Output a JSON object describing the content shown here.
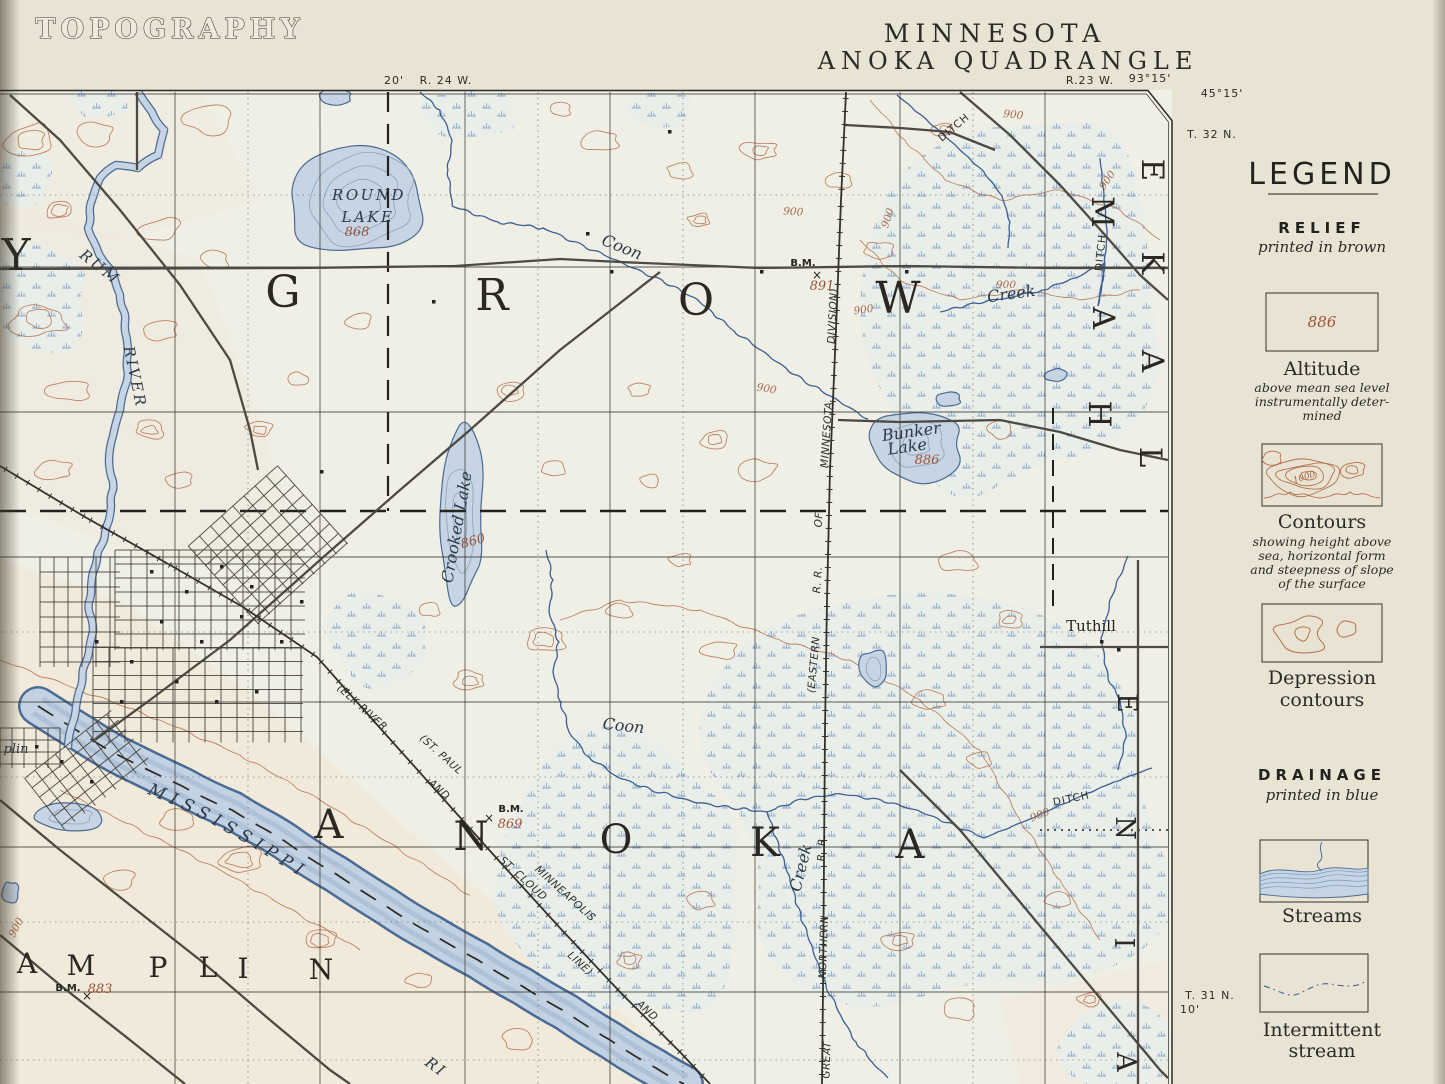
{
  "colors": {
    "paper": "#e9e3d4",
    "map_paper": "#f0efe5",
    "pink_tint": "#f3e3d2",
    "relief_brown": "#b4714c",
    "relief_number_brown": "#9e5237",
    "drainage_blue": "#4a6b94",
    "water_fill": "#c6d4e3",
    "marsh_blue": "#7fa0c6",
    "ink_black": "#262420",
    "road_grey": "#4c4a42"
  },
  "header": {
    "sheet_title": "TOPOGRAPHY",
    "state": "MINNESOTA",
    "quadrangle": "ANOKA QUADRANGLE"
  },
  "margin": {
    "top_minute": "20'",
    "range_west": "R. 24 W.",
    "range_east": "R.23 W.",
    "longitude": "93°15'",
    "latitude": "45°15'",
    "township_ne": "T. 32 N.",
    "township_se": "T. 31 N.",
    "minute_se": "10'"
  },
  "legend": {
    "title": "LEGEND",
    "relief_heading": "RELIEF",
    "relief_sub": "printed in brown",
    "altitude_value": "886",
    "altitude_label": "Altitude",
    "altitude_desc_lines": [
      "above mean sea level",
      "instrumentally deter-",
      "mined"
    ],
    "contour_value": "1000",
    "contours_label": "Contours",
    "contours_desc_lines": [
      "showing height above",
      "sea, horizontal form",
      "and steepness of slope",
      "of the surface"
    ],
    "depression_label_lines": [
      "Depression",
      "contours"
    ],
    "drainage_heading": "DRAINAGE",
    "drainage_sub": "printed in blue",
    "streams_label": "Streams",
    "intermittent_label_lines": [
      "Intermittent",
      "stream"
    ]
  },
  "map": {
    "river_label": "MISSISSIPPI",
    "labels": [
      {
        "t": "Y",
        "x": 16,
        "y": 270,
        "r": 0,
        "c": "lg1",
        "n": "label-county-letter-y"
      },
      {
        "t": "G",
        "x": 283,
        "y": 307,
        "r": 0,
        "c": "lg1",
        "n": "label-grow-g"
      },
      {
        "t": "R",
        "x": 492,
        "y": 310,
        "r": 0,
        "c": "lg1",
        "n": "label-grow-r"
      },
      {
        "t": "O",
        "x": 696,
        "y": 315,
        "r": 0,
        "c": "lg1",
        "n": "label-grow-o"
      },
      {
        "t": "W",
        "x": 898,
        "y": 313,
        "r": 0,
        "c": "lg1",
        "n": "label-grow-w"
      },
      {
        "t": "A",
        "x": 329,
        "y": 838,
        "r": 0,
        "c": "lg2",
        "n": "label-anoka-a1"
      },
      {
        "t": "N",
        "x": 471,
        "y": 850,
        "r": 0,
        "c": "lg2",
        "n": "label-anoka-n"
      },
      {
        "t": "O",
        "x": 616,
        "y": 853,
        "r": 0,
        "c": "lg2",
        "n": "label-anoka-o"
      },
      {
        "t": "K",
        "x": 765,
        "y": 856,
        "r": 0,
        "c": "lg2",
        "n": "label-anoka-k"
      },
      {
        "t": "A",
        "x": 910,
        "y": 858,
        "r": 0,
        "c": "lg2",
        "n": "label-anoka-a2"
      },
      {
        "t": "A",
        "x": 27,
        "y": 973,
        "r": 0,
        "c": "lg3",
        "n": "label-champlin-a"
      },
      {
        "t": "M",
        "x": 81,
        "y": 975,
        "r": 0,
        "c": "lg3",
        "n": "label-champlin-m"
      },
      {
        "t": "P",
        "x": 158,
        "y": 977,
        "r": 0,
        "c": "lg3",
        "n": "label-champlin-p"
      },
      {
        "t": "L",
        "x": 208,
        "y": 977,
        "r": 0,
        "c": "lg3",
        "n": "label-champlin-l"
      },
      {
        "t": "I",
        "x": 243,
        "y": 978,
        "r": 0,
        "c": "lg3",
        "n": "label-champlin-i"
      },
      {
        "t": "N",
        "x": 321,
        "y": 979,
        "r": 0,
        "c": "lg3",
        "n": "label-champlin-n"
      },
      {
        "t": "M",
        "x": 1092,
        "y": 212,
        "r": 90,
        "c": "lg4",
        "n": "label-ham-m"
      },
      {
        "t": "A",
        "x": 1093,
        "y": 318,
        "r": 90,
        "c": "lg4",
        "n": "label-ham-a"
      },
      {
        "t": "H",
        "x": 1089,
        "y": 414,
        "r": 90,
        "c": "lg4",
        "n": "label-ham-h"
      },
      {
        "t": "E",
        "x": 1142,
        "y": 170,
        "r": 90,
        "c": "lg4",
        "n": "label-lake-e"
      },
      {
        "t": "K",
        "x": 1142,
        "y": 263,
        "r": 90,
        "c": "lg4",
        "n": "label-lake-k"
      },
      {
        "t": "A",
        "x": 1142,
        "y": 361,
        "r": 90,
        "c": "lg4",
        "n": "label-lake-a"
      },
      {
        "t": "L",
        "x": 1140,
        "y": 457,
        "r": 90,
        "c": "lg4",
        "n": "label-lake-l"
      },
      {
        "t": "E",
        "x": 1118,
        "y": 703,
        "r": 90,
        "c": "lg5",
        "n": "label-blaine-e"
      },
      {
        "t": "N",
        "x": 1116,
        "y": 828,
        "r": 90,
        "c": "lg5",
        "n": "label-blaine-n"
      },
      {
        "t": "I",
        "x": 1115,
        "y": 943,
        "r": 90,
        "c": "lg5",
        "n": "label-blaine-i"
      },
      {
        "t": "A",
        "x": 1117,
        "y": 1062,
        "r": 90,
        "c": "lg5",
        "n": "label-blaine-a"
      },
      {
        "t": "ROUND",
        "x": 369,
        "y": 200,
        "r": 0,
        "c": "watc",
        "n": "label-round-lake-1"
      },
      {
        "t": "LAKE",
        "x": 368,
        "y": 222,
        "r": 0,
        "c": "watc",
        "n": "label-round-lake-2"
      },
      {
        "t": "868",
        "x": 357,
        "y": 236,
        "r": 0,
        "c": "num",
        "n": "label-round-lake-elev"
      },
      {
        "t": "RUM",
        "x": 97,
        "y": 271,
        "r": 38,
        "c": "watc",
        "n": "label-rum"
      },
      {
        "t": "RIVER",
        "x": 130,
        "y": 378,
        "r": 78,
        "c": "watc",
        "n": "label-rum-river"
      },
      {
        "t": "Crooked Lake",
        "x": 462,
        "y": 528,
        "r": -80,
        "c": "wat",
        "n": "label-crooked-lake"
      },
      {
        "t": "860",
        "x": 474,
        "y": 545,
        "r": -15,
        "c": "num",
        "n": "label-crooked-lake-elev"
      },
      {
        "t": "Bunker",
        "x": 912,
        "y": 437,
        "r": -8,
        "c": "wat",
        "n": "label-bunker-lake-1"
      },
      {
        "t": "Lake",
        "x": 908,
        "y": 452,
        "r": -8,
        "c": "wat",
        "n": "label-bunker-lake-2"
      },
      {
        "t": "886",
        "x": 927,
        "y": 464,
        "r": 0,
        "c": "num",
        "n": "label-bunker-lake-elev"
      },
      {
        "t": "Coon",
        "x": 620,
        "y": 252,
        "r": 22,
        "c": "wat",
        "n": "label-coon-upper"
      },
      {
        "t": "Creek",
        "x": 1012,
        "y": 299,
        "r": -8,
        "c": "wat",
        "n": "label-creek-upper"
      },
      {
        "t": "Coon",
        "x": 623,
        "y": 731,
        "r": 6,
        "c": "wat",
        "n": "label-coon-lower"
      },
      {
        "t": "Creek",
        "x": 806,
        "y": 869,
        "r": -76,
        "c": "wat",
        "n": "label-creek-lower"
      },
      {
        "t": "plin",
        "x": 16,
        "y": 753,
        "r": 0,
        "c": "watsm",
        "n": "label-champlin-village"
      },
      {
        "t": "RI",
        "x": 433,
        "y": 1071,
        "r": 36,
        "c": "watc",
        "n": "label-river-partial"
      },
      {
        "t": "DITCH",
        "x": 956,
        "y": 130,
        "r": -40,
        "c": "sm",
        "n": "label-ditch-1"
      },
      {
        "t": "DITCH",
        "x": 1104,
        "y": 253,
        "r": -84,
        "c": "sm",
        "n": "label-ditch-2"
      },
      {
        "t": "DITCH",
        "x": 1072,
        "y": 802,
        "r": -12,
        "c": "sm",
        "n": "label-ditch-3"
      },
      {
        "t": "Tuthill",
        "x": 1091,
        "y": 631,
        "r": 0,
        "c": "loc",
        "n": "label-tuthill"
      },
      {
        "t": "B.M.",
        "x": 803,
        "y": 266,
        "r": 0,
        "c": "bm",
        "n": "label-bm-1"
      },
      {
        "t": "891",
        "x": 822,
        "y": 290,
        "r": 0,
        "c": "num",
        "n": "label-bm-1-elev"
      },
      {
        "t": "×",
        "x": 817,
        "y": 279,
        "r": 0,
        "c": "bmx",
        "n": "bm-cross-1"
      },
      {
        "t": "B.M.",
        "x": 511,
        "y": 812,
        "r": 0,
        "c": "bm",
        "n": "label-bm-2"
      },
      {
        "t": "869",
        "x": 510,
        "y": 828,
        "r": 0,
        "c": "num",
        "n": "label-bm-2-elev"
      },
      {
        "t": "×",
        "x": 489,
        "y": 822,
        "r": 0,
        "c": "bmx",
        "n": "bm-cross-2"
      },
      {
        "t": "B.M.",
        "x": 68,
        "y": 991,
        "r": 0,
        "c": "bm",
        "n": "label-bm-3"
      },
      {
        "t": "883",
        "x": 100,
        "y": 993,
        "r": 0,
        "c": "num",
        "n": "label-bm-3-elev"
      },
      {
        "t": "×",
        "x": 87,
        "y": 1000,
        "r": 0,
        "c": "bmx",
        "n": "bm-cross-3"
      },
      {
        "t": "900",
        "x": 1013,
        "y": 118,
        "r": 6,
        "c": "cnum",
        "n": "contour-label"
      },
      {
        "t": "900",
        "x": 891,
        "y": 219,
        "r": -72,
        "c": "cnum",
        "n": "contour-label"
      },
      {
        "t": "900",
        "x": 1110,
        "y": 182,
        "r": -55,
        "c": "cnum",
        "n": "contour-label"
      },
      {
        "t": "900",
        "x": 793,
        "y": 215,
        "r": 4,
        "c": "cnum",
        "n": "contour-label"
      },
      {
        "t": "900",
        "x": 1006,
        "y": 288,
        "r": 0,
        "c": "cnum",
        "n": "contour-label"
      },
      {
        "t": "900",
        "x": 766,
        "y": 392,
        "r": 10,
        "c": "cnum",
        "n": "contour-label"
      },
      {
        "t": "900",
        "x": 1041,
        "y": 818,
        "r": -22,
        "c": "cnum",
        "n": "contour-label"
      },
      {
        "t": "900",
        "x": 19,
        "y": 929,
        "r": -62,
        "c": "cnum",
        "n": "contour-label"
      },
      {
        "t": "900",
        "x": 864,
        "y": 313,
        "r": -8,
        "c": "cnum",
        "n": "contour-label"
      },
      {
        "t": "(ELK RIVER",
        "x": 360,
        "y": 710,
        "r": 42,
        "c": "rr",
        "n": "label-rr-elk-river"
      },
      {
        "t": "AND",
        "x": 437,
        "y": 792,
        "r": 42,
        "c": "rr",
        "n": "label-rr-and-1"
      },
      {
        "t": "ST. CLOUD",
        "x": 521,
        "y": 881,
        "r": 42,
        "c": "rr",
        "n": "label-rr-st-cloud"
      },
      {
        "t": "LINE)",
        "x": 578,
        "y": 966,
        "r": 42,
        "c": "rr",
        "n": "label-rr-line"
      },
      {
        "t": "(ST. PAUL",
        "x": 439,
        "y": 757,
        "r": 42,
        "c": "rr",
        "n": "label-rr-st-paul"
      },
      {
        "t": "MINNEAPOLIS",
        "x": 563,
        "y": 896,
        "r": 42,
        "c": "rr",
        "n": "label-rr-minneapolis"
      },
      {
        "t": "AND",
        "x": 645,
        "y": 1013,
        "r": 42,
        "c": "rr",
        "n": "label-rr-and-2"
      },
      {
        "t": "GREAT",
        "x": 830,
        "y": 1060,
        "r": -88,
        "c": "rr",
        "n": "label-rr-great"
      },
      {
        "t": "NORTHERN",
        "x": 827,
        "y": 947,
        "r": -88,
        "c": "rr",
        "n": "label-rr-northern"
      },
      {
        "t": "R. R.",
        "x": 825,
        "y": 848,
        "r": -88,
        "c": "rr",
        "n": "label-rr-rr-1"
      },
      {
        "t": "(EASTERN",
        "x": 817,
        "y": 665,
        "r": -85,
        "c": "rr",
        "n": "label-rr-eastern"
      },
      {
        "t": "R. R.",
        "x": 821,
        "y": 580,
        "r": -86,
        "c": "rr",
        "n": "label-rr-rr-2"
      },
      {
        "t": "OF",
        "x": 822,
        "y": 520,
        "r": -86,
        "c": "rr",
        "n": "label-rr-of"
      },
      {
        "t": "MINNESOTA",
        "x": 830,
        "y": 435,
        "r": -86,
        "c": "rr",
        "n": "label-rr-minnesota"
      },
      {
        "t": "DIVISION)",
        "x": 836,
        "y": 316,
        "r": -87,
        "c": "rr",
        "n": "label-rr-division"
      }
    ]
  }
}
